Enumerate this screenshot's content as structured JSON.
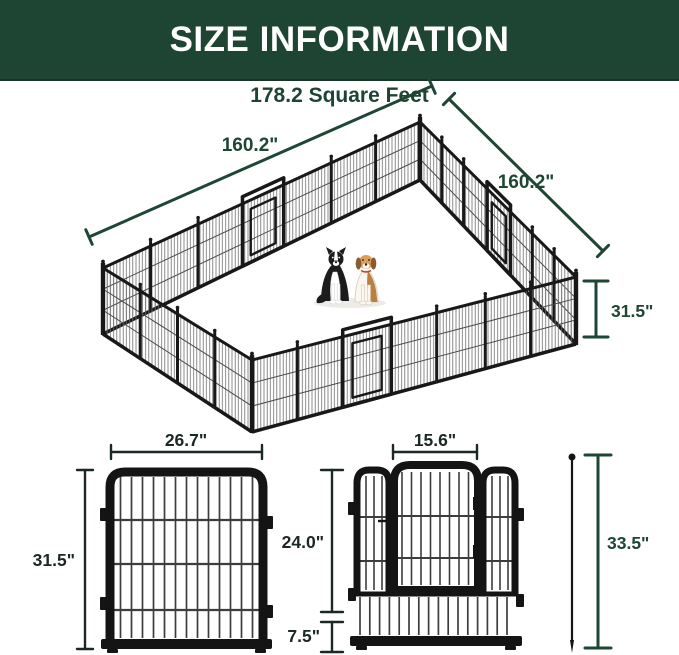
{
  "header": {
    "title": "SIZE INFORMATION"
  },
  "subtitle": "178.2 Square Feet",
  "colors": {
    "header_bg": "#1e4434",
    "header_text": "#ffffff",
    "dimension_green": "#1e4634",
    "dimension_dark": "#1b2823",
    "fence_frame": "#181818"
  },
  "pen": {
    "back_left_width": "160.2\"",
    "back_right_width": "160.2\"",
    "panel_height": "31.5\"",
    "dogs": [
      "border-collie-icon",
      "beagle-icon"
    ]
  },
  "panel": {
    "width": "26.7\"",
    "height": "31.5\""
  },
  "door_panel": {
    "door_width": "15.6\"",
    "door_height": "24.0\"",
    "bottom_height": "7.5\"",
    "stake_height": "33.5\""
  }
}
